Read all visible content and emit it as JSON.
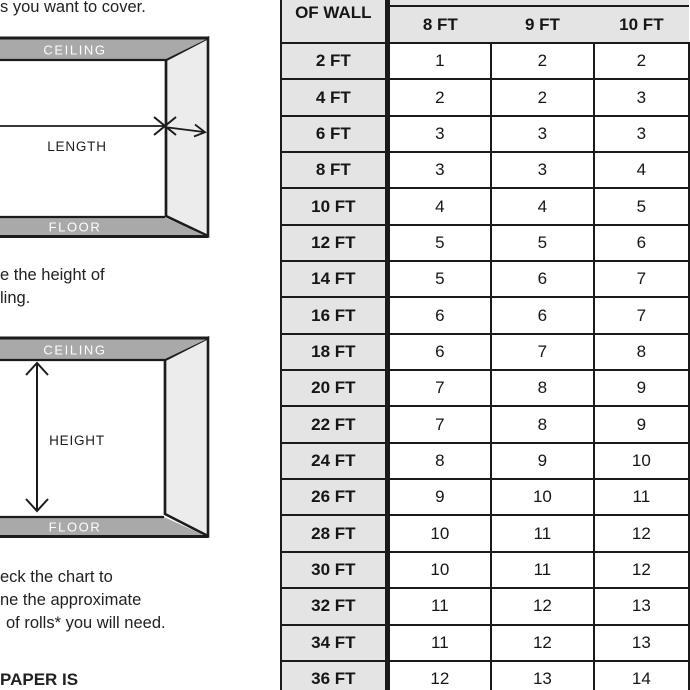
{
  "fragments": {
    "step1": "s you want to cover.",
    "step2_line1": "e the height of",
    "step2_line2": "ling.",
    "step3_line1": "eck the chart to",
    "step3_line2": "ne the approximate",
    "step3_line3": "of rolls* you will need.",
    "note": "PAPER IS"
  },
  "diagram_length": {
    "ceiling_label": "CEILING",
    "floor_label": "FLOOR",
    "measure_label": "LENGTH"
  },
  "diagram_height": {
    "ceiling_label": "CEILING",
    "floor_label": "FLOOR",
    "measure_label": "HEIGHT"
  },
  "chart": {
    "corner_header": "OF WALL",
    "col_headers": [
      "8 FT",
      "9 FT",
      "10 FT"
    ],
    "rows": [
      {
        "label": "2 FT",
        "values": [
          1,
          2,
          2
        ]
      },
      {
        "label": "4 FT",
        "values": [
          2,
          2,
          3
        ]
      },
      {
        "label": "6 FT",
        "values": [
          3,
          3,
          3
        ]
      },
      {
        "label": "8 FT",
        "values": [
          3,
          3,
          4
        ]
      },
      {
        "label": "10 FT",
        "values": [
          4,
          4,
          5
        ]
      },
      {
        "label": "12 FT",
        "values": [
          5,
          5,
          6
        ]
      },
      {
        "label": "14 FT",
        "values": [
          5,
          6,
          7
        ]
      },
      {
        "label": "16 FT",
        "values": [
          6,
          6,
          7
        ]
      },
      {
        "label": "18 FT",
        "values": [
          6,
          7,
          8
        ]
      },
      {
        "label": "20 FT",
        "values": [
          7,
          8,
          9
        ]
      },
      {
        "label": "22 FT",
        "values": [
          7,
          8,
          9
        ]
      },
      {
        "label": "24 FT",
        "values": [
          8,
          9,
          10
        ]
      },
      {
        "label": "26 FT",
        "values": [
          9,
          10,
          11
        ]
      },
      {
        "label": "28 FT",
        "values": [
          10,
          11,
          12
        ]
      },
      {
        "label": "30 FT",
        "values": [
          10,
          11,
          12
        ]
      },
      {
        "label": "32 FT",
        "values": [
          11,
          12,
          13
        ]
      },
      {
        "label": "34 FT",
        "values": [
          11,
          12,
          13
        ]
      },
      {
        "label": "36 FT",
        "values": [
          12,
          13,
          14
        ]
      }
    ]
  },
  "colors": {
    "band_gray": "#a9a9a9",
    "side_wall_gray": "#ececec",
    "header_cell_gray": "#e4e4e4",
    "table_line": "#1a1a1a",
    "text": "#212121"
  }
}
